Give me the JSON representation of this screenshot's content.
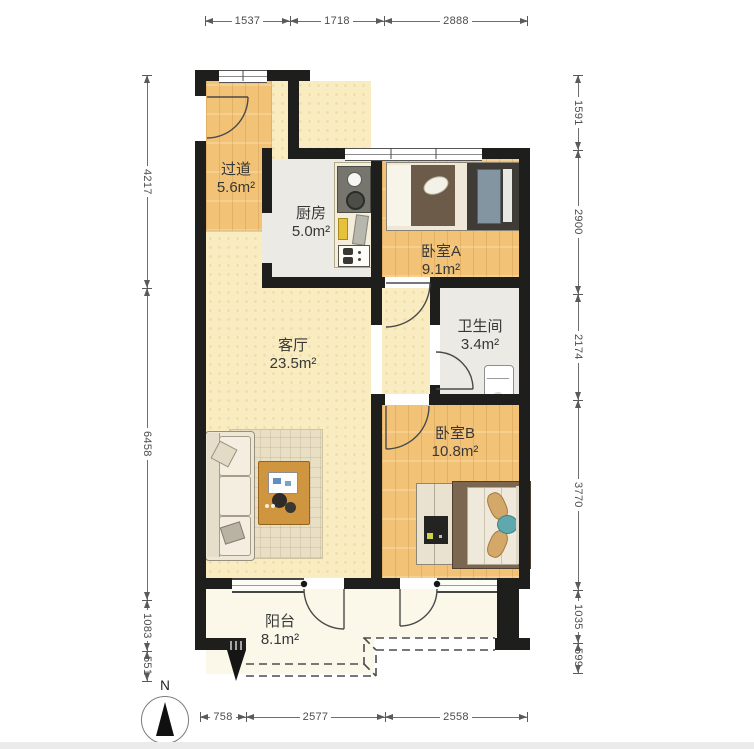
{
  "title": "two-bedroom apartment floor plan",
  "compass": {
    "label": "N"
  },
  "rooms": [
    {
      "id": "hallway",
      "name": "过道",
      "area": "5.6m²"
    },
    {
      "id": "kitchen",
      "name": "厨房",
      "area": "5.0m²"
    },
    {
      "id": "bedroom-a",
      "name": "卧室A",
      "area": "9.1m²"
    },
    {
      "id": "bathroom",
      "name": "卫生间",
      "area": "3.4m²"
    },
    {
      "id": "living-room",
      "name": "客厅",
      "area": "23.5m²"
    },
    {
      "id": "bedroom-b",
      "name": "卧室B",
      "area": "10.8m²"
    },
    {
      "id": "balcony",
      "name": "阳台",
      "area": "8.1m²"
    }
  ],
  "dimensions_mm": {
    "top": [
      "1537",
      "1718",
      "2888"
    ],
    "bottom": [
      "758",
      "2577",
      "2558"
    ],
    "left": [
      "4217",
      "6458",
      "1083",
      "551"
    ],
    "right": [
      "1591",
      "2900",
      "2174",
      "3770",
      "1035",
      "599"
    ]
  },
  "colors": {
    "wall": "#1e1e1c",
    "wood_floor": "#f2c377",
    "living_floor": "#f8ecc0",
    "tile_floor": "#eceae4",
    "balcony_floor": "#fbf8ea",
    "dimension_text": "#4c4c4c",
    "label_text": "#383838",
    "accent_teal": "#5fa8ad",
    "accent_brown": "#6d5b49"
  }
}
